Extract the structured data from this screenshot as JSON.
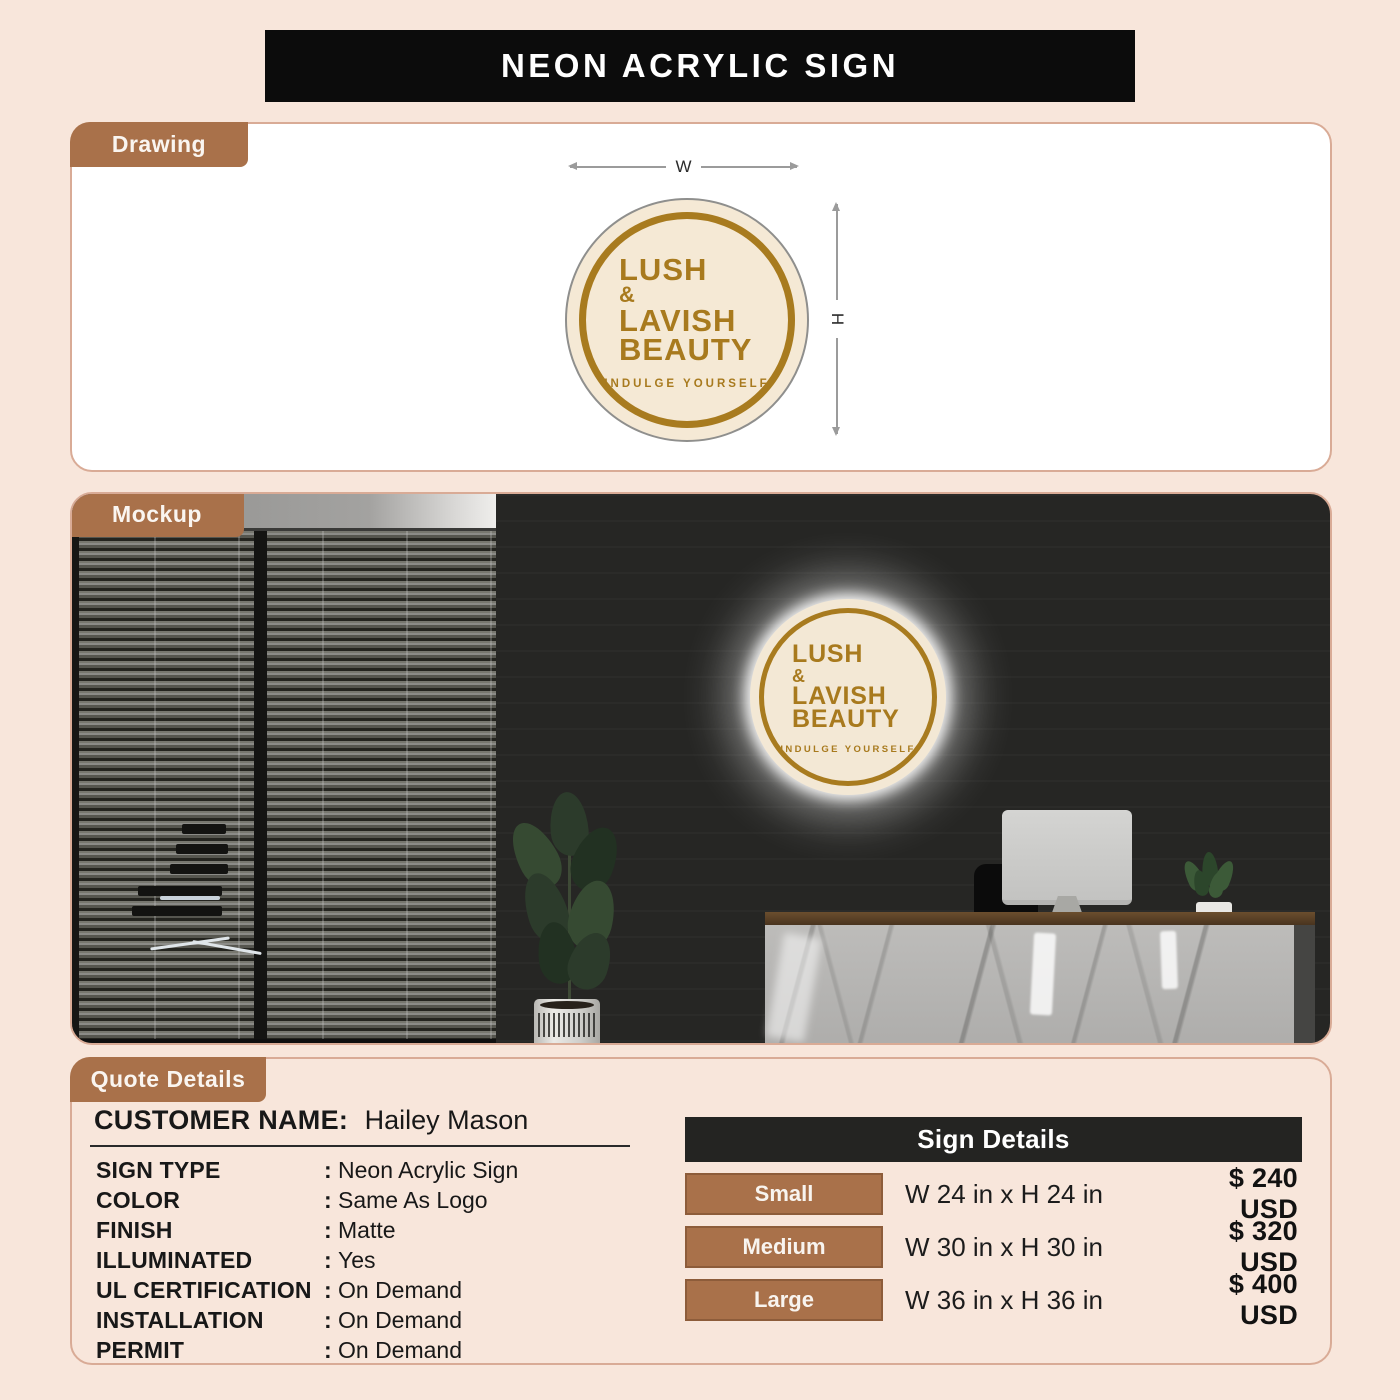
{
  "title": "NEON ACRYLIC SIGN",
  "sections": {
    "drawing": "Drawing",
    "mockup": "Mockup",
    "quote": "Quote Details"
  },
  "logo": {
    "line1": "LUSH",
    "line2": "&",
    "line3": "LAVISH",
    "line4": "BEAUTY",
    "tagline": "INDULGE YOURSELF"
  },
  "drawing": {
    "width_label": "W",
    "height_label": "H"
  },
  "quote": {
    "customer_label": "CUSTOMER NAME:",
    "customer_name": "Hailey Mason",
    "colon": ":",
    "specs": [
      {
        "label": "SIGN TYPE",
        "value": "Neon Acrylic Sign"
      },
      {
        "label": "COLOR",
        "value": "Same As Logo"
      },
      {
        "label": "FINISH",
        "value": "Matte"
      },
      {
        "label": "ILLUMINATED",
        "value": "Yes"
      },
      {
        "label": "UL CERTIFICATION",
        "value": "On Demand"
      },
      {
        "label": "INSTALLATION",
        "value": "On Demand"
      },
      {
        "label": "PERMIT",
        "value": "On Demand"
      }
    ]
  },
  "sign_details": {
    "title": "Sign Details",
    "rows": [
      {
        "size": "Small",
        "dimensions": "W 24 in x H 24 in",
        "price": "$ 240 USD"
      },
      {
        "size": "Medium",
        "dimensions": "W 30 in x H 30 in",
        "price": "$ 320 USD"
      },
      {
        "size": "Large",
        "dimensions": "W 36 in x H 36 in",
        "price": "$ 400 USD"
      }
    ]
  },
  "colors": {
    "accent_brown": "#a9714a",
    "logo_gold": "#a87a1e",
    "logo_cream": "#f5e9d5",
    "page_background": "#f8e6db",
    "header_black": "#0c0c0c",
    "panel_border": "#d9ab96"
  }
}
